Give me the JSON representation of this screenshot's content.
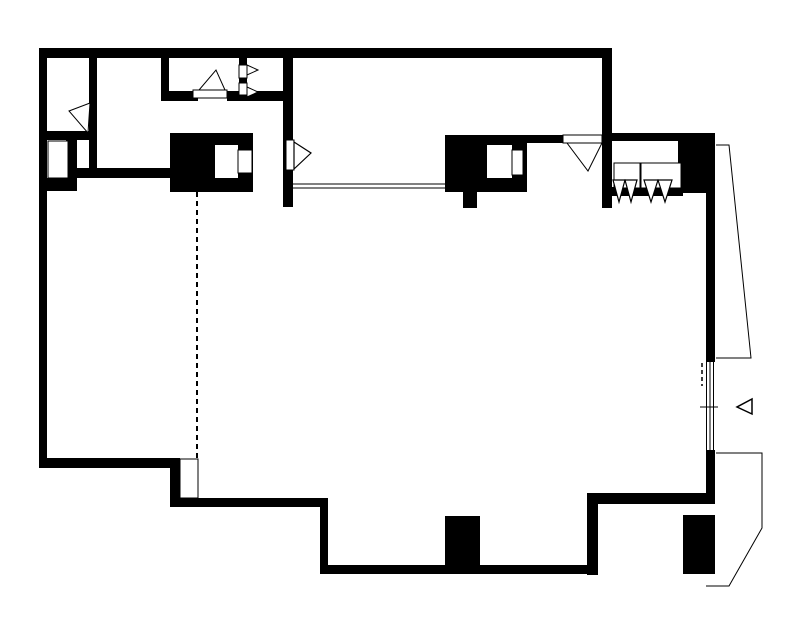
{
  "meta": {
    "description": "black-and-white architectural floor plan drawing",
    "width": 797,
    "height": 627,
    "colors": {
      "ink": "#000000",
      "background": "#ffffff"
    }
  },
  "plan": {
    "walls": [
      {
        "name": "top-wall",
        "x": 39,
        "y": 48,
        "w": 573,
        "h": 10
      },
      {
        "name": "left-wall",
        "x": 39,
        "y": 48,
        "w": 8,
        "h": 417
      },
      {
        "name": "wc-room-left-wall",
        "x": 161,
        "y": 50,
        "w": 8,
        "h": 51
      },
      {
        "name": "wc-room-south-wall-west",
        "x": 161,
        "y": 91,
        "w": 37,
        "h": 10
      },
      {
        "name": "wc-room-south-wall-east",
        "x": 227,
        "y": 91,
        "w": 66,
        "h": 10
      },
      {
        "name": "hall-partition-wall",
        "x": 89,
        "y": 48,
        "w": 8,
        "h": 120
      },
      {
        "name": "closet-top-wall",
        "x": 39,
        "y": 131,
        "w": 58,
        "h": 9
      },
      {
        "name": "duct-east-wall",
        "x": 66,
        "y": 139,
        "w": 11,
        "h": 52
      },
      {
        "name": "duct-south-wall",
        "x": 39,
        "y": 178,
        "w": 38,
        "h": 13
      },
      {
        "name": "closet-south-wall",
        "x": 60,
        "y": 168,
        "w": 113,
        "h": 10
      },
      {
        "name": "living-room-west-wall",
        "x": 283,
        "y": 48,
        "w": 10,
        "h": 159
      },
      {
        "name": "kitchen-door-wall",
        "x": 523,
        "y": 135,
        "w": 44,
        "h": 8
      },
      {
        "name": "entry-east-wall",
        "x": 602,
        "y": 48,
        "w": 10,
        "h": 160
      },
      {
        "name": "alcove-top-wall",
        "x": 612,
        "y": 133,
        "w": 71,
        "h": 8
      },
      {
        "name": "east-pier-block",
        "x": 678,
        "y": 133,
        "w": 37,
        "h": 60
      },
      {
        "name": "alcove-bottom-band",
        "x": 612,
        "y": 187,
        "w": 71,
        "h": 9
      },
      {
        "name": "east-wall-upper",
        "x": 706,
        "y": 193,
        "w": 9,
        "h": 169
      },
      {
        "name": "east-wall-lower",
        "x": 706,
        "y": 450,
        "w": 9,
        "h": 54
      },
      {
        "name": "southeast-wall",
        "x": 587,
        "y": 493,
        "w": 128,
        "h": 11
      },
      {
        "name": "southeast-step-wall",
        "x": 587,
        "y": 493,
        "w": 11,
        "h": 82
      },
      {
        "name": "south-wall",
        "x": 320,
        "y": 565,
        "w": 278,
        "h": 9
      },
      {
        "name": "south-step-wall",
        "x": 320,
        "y": 498,
        "w": 8,
        "h": 75
      },
      {
        "name": "south-wall-west",
        "x": 180,
        "y": 498,
        "w": 148,
        "h": 9
      },
      {
        "name": "southwest-step-wall",
        "x": 170,
        "y": 458,
        "w": 10,
        "h": 49
      },
      {
        "name": "southwest-wall",
        "x": 39,
        "y": 458,
        "w": 141,
        "h": 10
      },
      {
        "name": "fireplace-block-west",
        "x": 170,
        "y": 133,
        "w": 83,
        "h": 59
      },
      {
        "name": "fireplace-block-east",
        "x": 445,
        "y": 135,
        "w": 82,
        "h": 57
      },
      {
        "name": "fireplace-stub",
        "x": 463,
        "y": 192,
        "w": 14,
        "h": 16
      },
      {
        "name": "south-column",
        "x": 445,
        "y": 516,
        "w": 35,
        "h": 52
      },
      {
        "name": "southeast-column",
        "x": 683,
        "y": 515,
        "w": 32,
        "h": 59
      },
      {
        "name": "jamb-mullion-a",
        "x": 239,
        "y": 58,
        "w": 8,
        "h": 7
      },
      {
        "name": "jamb-mullion-b",
        "x": 239,
        "y": 78,
        "w": 8,
        "h": 5
      }
    ],
    "openings": [
      {
        "name": "fireplace-west-opening",
        "x": 215,
        "y": 145,
        "w": 23,
        "h": 33
      },
      {
        "name": "fireplace-east-opening",
        "x": 487,
        "y": 145,
        "w": 25,
        "h": 33
      }
    ],
    "fixtures": [
      {
        "name": "fireplace-west-niche",
        "x": 238,
        "y": 150,
        "w": 14,
        "h": 23
      },
      {
        "name": "fireplace-east-niche",
        "x": 512,
        "y": 150,
        "w": 11,
        "h": 25
      },
      {
        "name": "duct-shaft",
        "x": 48,
        "y": 141,
        "w": 20,
        "h": 37
      },
      {
        "name": "entry-step",
        "x": 180,
        "y": 459,
        "w": 18,
        "h": 39
      },
      {
        "name": "jamb-panel-a",
        "x": 239,
        "y": 65,
        "w": 8,
        "h": 13
      },
      {
        "name": "jamb-panel-b",
        "x": 239,
        "y": 83,
        "w": 8,
        "h": 12
      },
      {
        "name": "alcove-shelf-west",
        "x": 614,
        "y": 163,
        "w": 26,
        "h": 25
      },
      {
        "name": "alcove-shelf-east",
        "x": 641,
        "y": 163,
        "w": 40,
        "h": 25
      },
      {
        "name": "door-leaf-wc",
        "x": 193,
        "y": 90,
        "w": 34,
        "h": 8
      },
      {
        "name": "door-leaf-living",
        "x": 286,
        "y": 140,
        "w": 8,
        "h": 30
      },
      {
        "name": "door-leaf-kitchen",
        "x": 563,
        "y": 135,
        "w": 39,
        "h": 8
      }
    ],
    "door_swings": [
      {
        "name": "door-swing-hall",
        "points": "69,111 90,103 88,133",
        "stroke_width": 1
      },
      {
        "name": "door-swing-wc",
        "points": "199,90 225,90 216,70",
        "stroke_width": 1
      },
      {
        "name": "door-swing-closet-a",
        "points": "247,65 258,70 247,75",
        "stroke_width": 1
      },
      {
        "name": "door-swing-closet-b",
        "points": "247,87 258,92 247,97",
        "stroke_width": 1
      },
      {
        "name": "door-swing-living",
        "points": "294,142 311,153 294,169",
        "stroke_width": 1.2
      },
      {
        "name": "door-swing-kitchen",
        "points": "567,143 602,143 588,171",
        "stroke_width": 1
      },
      {
        "name": "door-swing-terrace",
        "points": "752,399 752,414 737,407",
        "stroke_width": 1.5
      },
      {
        "name": "coat-hook-1",
        "points": "613,180 625,180 619,202",
        "stroke_width": 1.2
      },
      {
        "name": "coat-hook-2",
        "points": "625,180 637,180 631,202",
        "stroke_width": 1.2
      },
      {
        "name": "coat-hook-3",
        "points": "644,180 658,180 651,202",
        "stroke_width": 1.2
      },
      {
        "name": "coat-hook-4",
        "points": "658,180 672,180 665,202",
        "stroke_width": 1.2
      }
    ],
    "lines": [
      {
        "name": "counter-edge-a",
        "x1": 293,
        "y1": 184,
        "x2": 445,
        "y2": 184
      },
      {
        "name": "counter-edge-b",
        "x1": 293,
        "y1": 188,
        "x2": 445,
        "y2": 188
      },
      {
        "name": "glazing-line-a",
        "x1": 706.5,
        "y1": 362,
        "x2": 706.5,
        "y2": 450
      },
      {
        "name": "glazing-line-b",
        "x1": 710,
        "y1": 362,
        "x2": 710,
        "y2": 450
      },
      {
        "name": "glazing-line-c",
        "x1": 713.5,
        "y1": 362,
        "x2": 713.5,
        "y2": 450
      },
      {
        "name": "glazing-tick",
        "x1": 700,
        "y1": 407,
        "x2": 718,
        "y2": 407
      }
    ],
    "polylines": [
      {
        "name": "terrace-north-outline",
        "points": "716,145 729,145 751,358 716,358"
      },
      {
        "name": "terrace-south-outline",
        "points": "716,453 762,453 762,528 729,586 706,586"
      }
    ],
    "dashed_lines": [
      {
        "name": "span-dashed-line",
        "x1": 197,
        "y1": 192,
        "x2": 197,
        "y2": 458,
        "dash": "5,4",
        "stroke_width": 2
      },
      {
        "name": "glazing-dashed-line",
        "x1": 702,
        "y1": 363,
        "x2": 702,
        "y2": 386,
        "dash": "4,3",
        "stroke_width": 1.5
      }
    ]
  }
}
